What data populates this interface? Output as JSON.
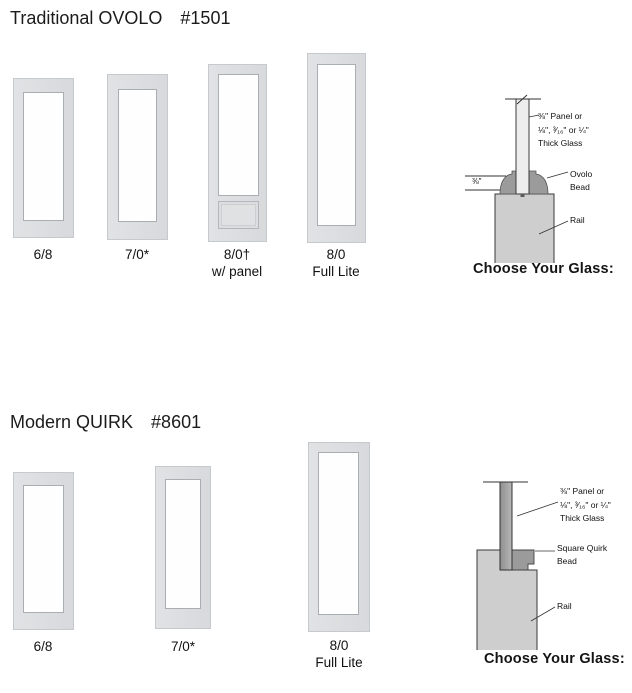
{
  "sections": [
    {
      "title": "Traditional OVOLO",
      "number": "#1501",
      "doors": [
        {
          "label": "6/8"
        },
        {
          "label": "7/0*"
        },
        {
          "label": "8/0†\nw/ panel"
        },
        {
          "label": "8/0\nFull Lite"
        }
      ],
      "diagram": {
        "panel_note": "⅜\" Panel or\n⅛\", ³⁄₁₆\" or ¼\"\nThick Glass",
        "bead_label": "Ovolo\nBead",
        "rail_label": "Rail",
        "dimension": "⅜\"",
        "choose_glass": "Choose Your Glass:"
      }
    },
    {
      "title": "Modern QUIRK",
      "number": "#8601",
      "doors": [
        {
          "label": "6/8"
        },
        {
          "label": "7/0*"
        },
        {
          "label": "8/0\nFull Lite"
        }
      ],
      "diagram": {
        "panel_note": "⅜\" Panel or\n⅛\", ³⁄₁₆\" or ¼\"\nThick Glass",
        "bead_label": "Square Quirk\nBead",
        "rail_label": "Rail",
        "choose_glass": "Choose Your Glass:"
      }
    }
  ],
  "colors": {
    "door_frame": "#d9dbdd",
    "glass_border": "#a9aeb3",
    "bead_gray": "#9b9b9b",
    "rail_gray": "#cdcecd",
    "panel_strip_light": "#ededed",
    "panel_strip_dark": "#8f8f8f",
    "text": "#1b1b1b"
  }
}
